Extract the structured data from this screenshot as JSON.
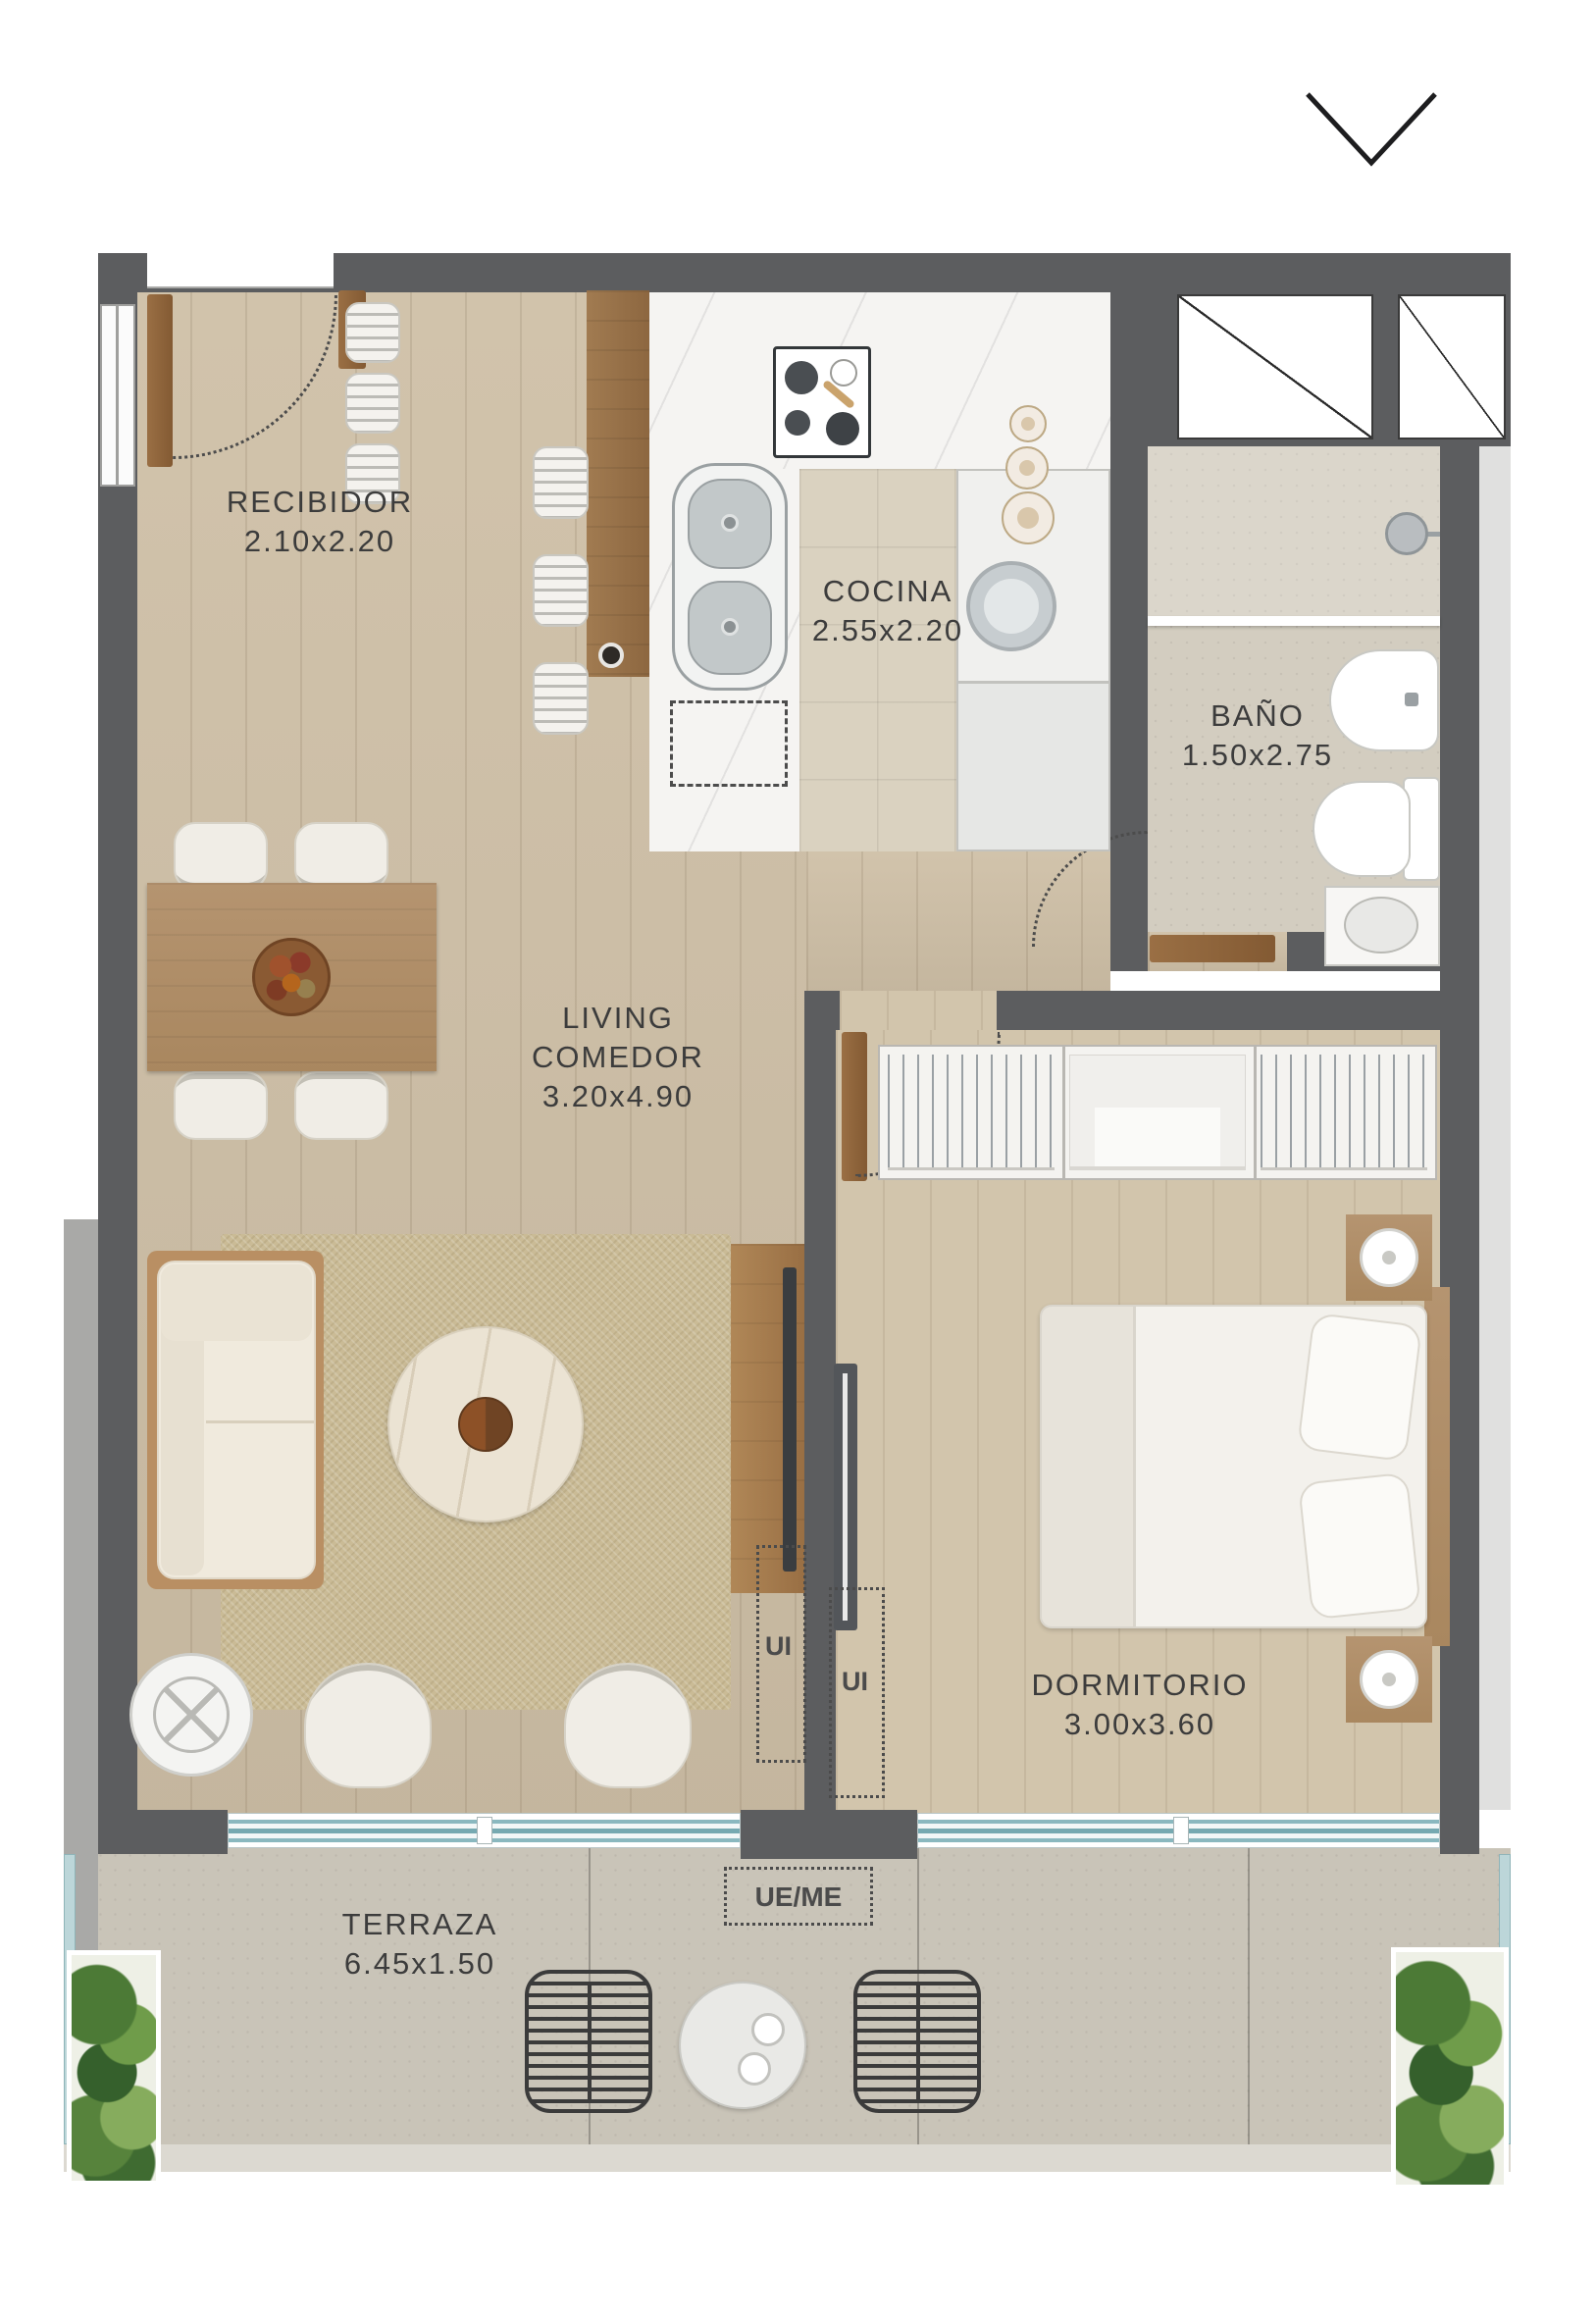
{
  "plan": {
    "rooms": [
      {
        "name": "RECIBIDOR",
        "dims": "2.10x2.20"
      },
      {
        "name": "COCINA",
        "dims": "2.55x2.20"
      },
      {
        "name": "BAÑO",
        "dims": "1.50x2.75"
      },
      {
        "name": "LIVING",
        "name_line2": "COMEDOR",
        "dims": "3.20x4.90"
      },
      {
        "name": "DORMITORIO",
        "dims": "3.00x3.60"
      },
      {
        "name": "TERRAZA",
        "dims": "6.45x1.50"
      }
    ],
    "markers": {
      "ui_living": "UI",
      "ui_dormitorio": "UI",
      "ue_me": "UE/ME"
    }
  },
  "icons": {
    "chevron_down": "chevron-down"
  },
  "colors": {
    "wall": "#5c5d5f",
    "wood_floor": "#cfc0a7",
    "bedroom_floor": "#d2c5ac",
    "kitchen_tile": "#dad2c0",
    "bath_floor": "#d3cdc0",
    "terrace_floor": "#c9c4b8",
    "window_glass": "#76a9b1",
    "furniture_wood": "#a9875f",
    "label_text": "#3c3c3c"
  }
}
